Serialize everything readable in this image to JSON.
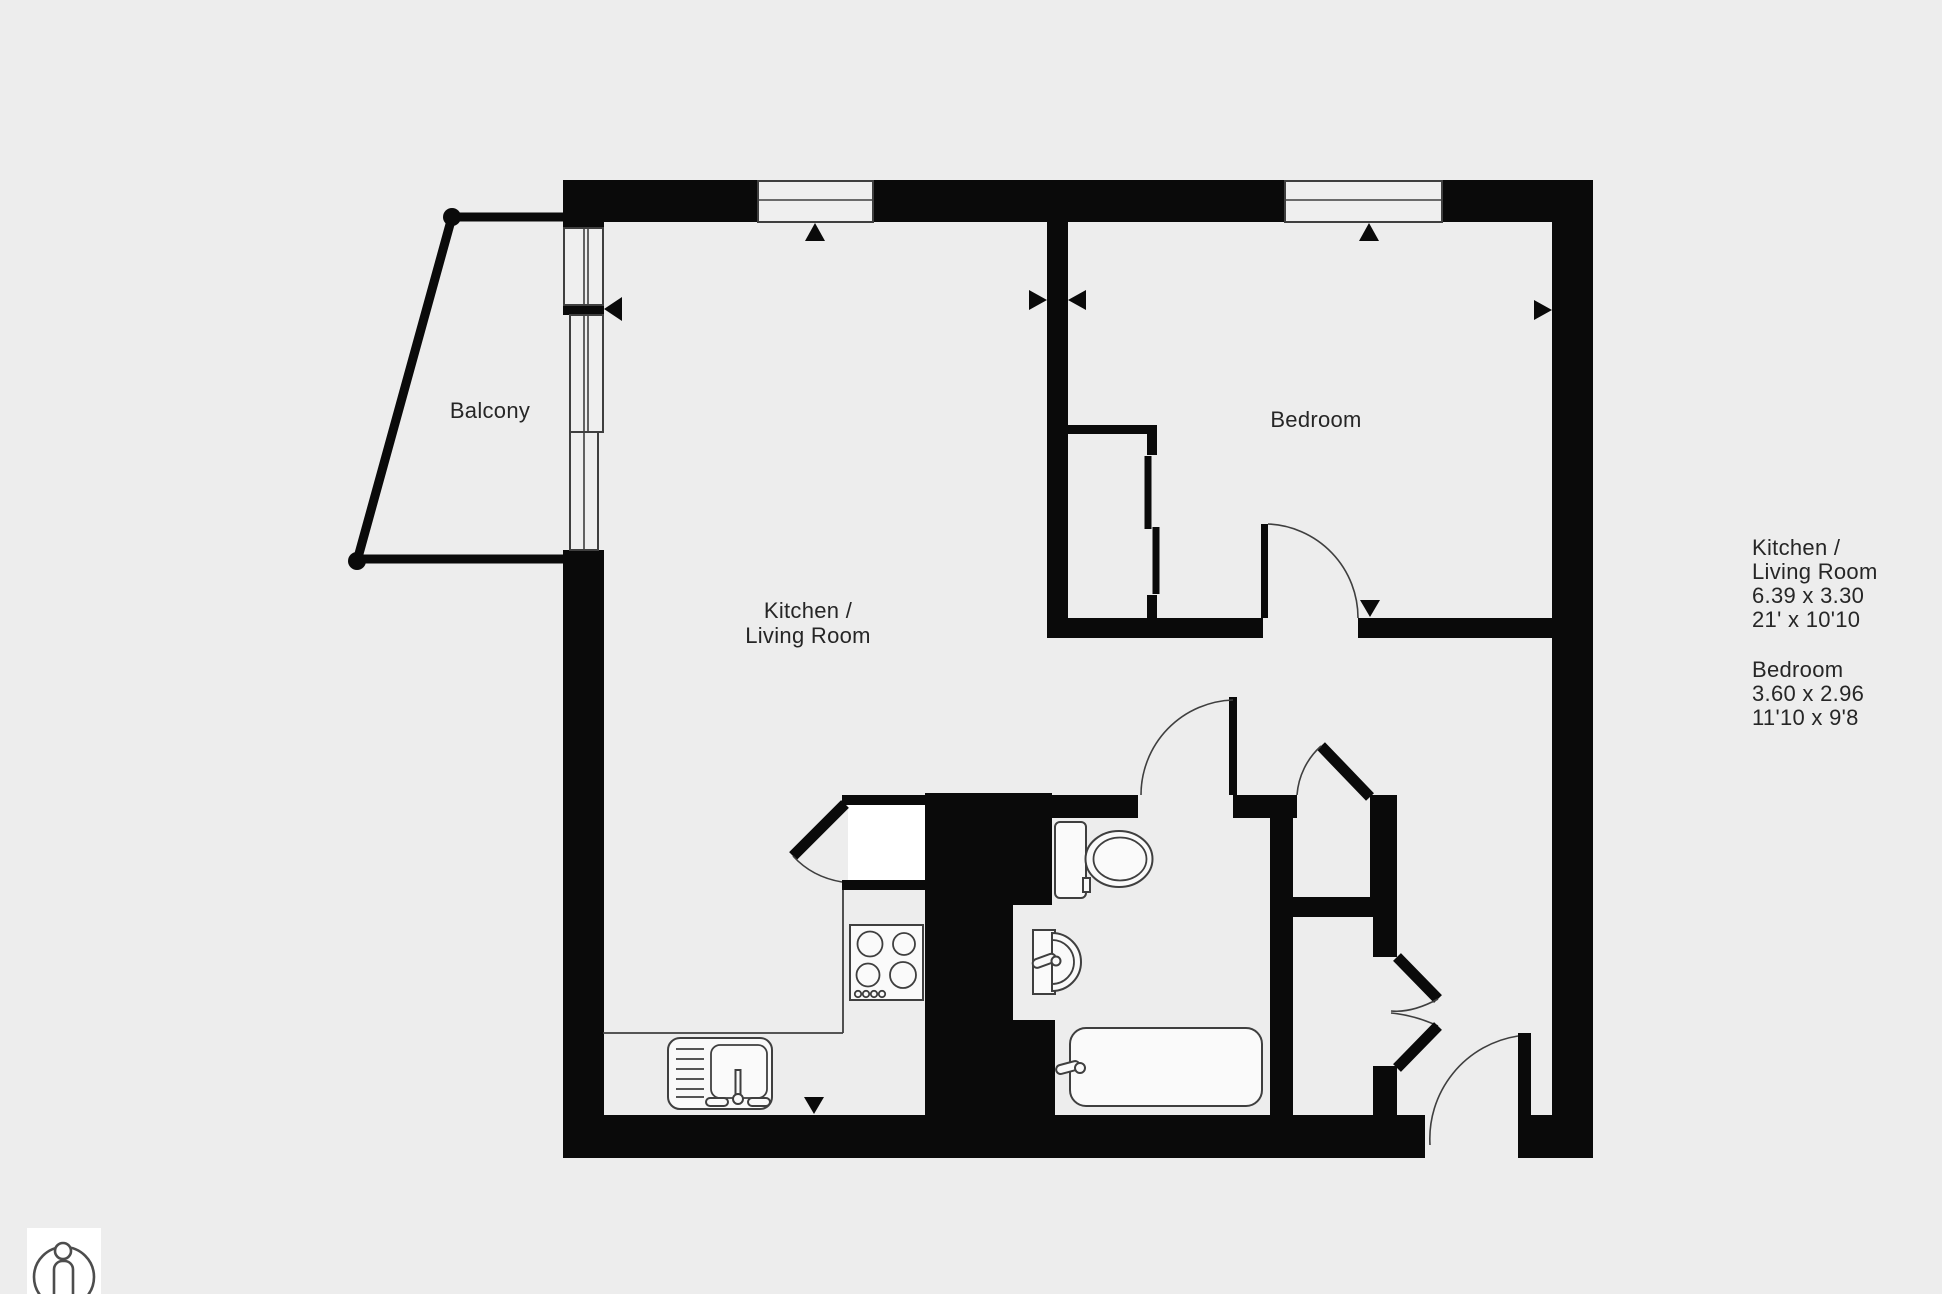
{
  "rooms": {
    "balcony": {
      "label": "Balcony"
    },
    "kitchen_living": {
      "label_lines": [
        "Kitchen /",
        "Living Room"
      ]
    },
    "bedroom": {
      "label": "Bedroom"
    }
  },
  "legend": {
    "kitchen_living": {
      "name_lines": [
        "Kitchen /",
        "Living Room"
      ],
      "metric": "6.39 x 3.30",
      "imperial": "21' x 10'10"
    },
    "bedroom": {
      "name": "Bedroom",
      "metric": "3.60 x 2.96",
      "imperial": "11'10 x 9'8"
    }
  },
  "icons": [
    {
      "name": "person-scale-icon"
    },
    {
      "name": "window-direction-markers"
    }
  ],
  "colors": {
    "background": "#ededed",
    "wall": "#0a0a0a",
    "window_fill": "#efefef",
    "fixture_fill": "#fafafa",
    "fixture_stroke": "#3f3f3f",
    "outline": "#3f3f3f",
    "text": "#262626",
    "card": "#ffffff",
    "person": "#4d4d4d"
  }
}
